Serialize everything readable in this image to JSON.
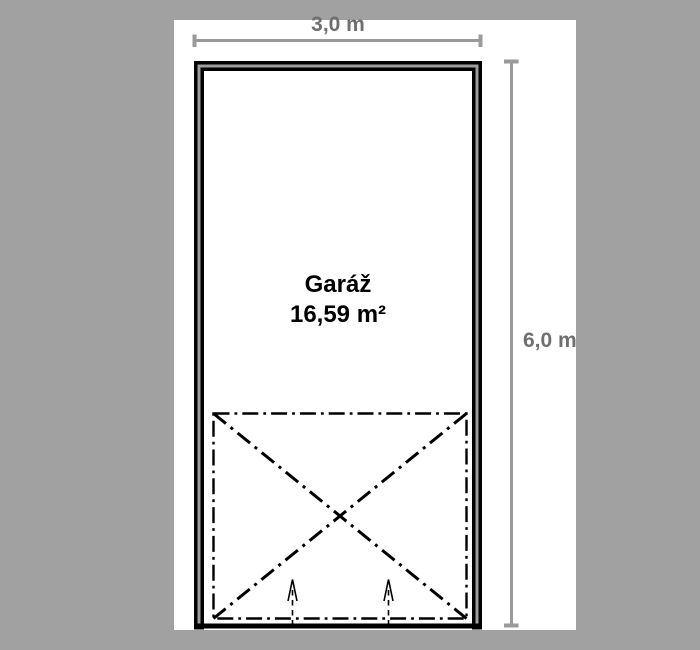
{
  "plan": {
    "room": {
      "name": "Garáž",
      "area": "16,59 m²"
    },
    "dimensions": {
      "width_label": "3,0 m",
      "height_label": "6,0 m"
    },
    "symbols": {
      "garage_door": "dash-dot rectangle with corner-to-corner X diagonals",
      "opening_direction": "two dashed arrows pointing up (inward) through the opening"
    }
  },
  "colors": {
    "background": "#a1a1a1",
    "paper": "#ffffff",
    "wall_line": "#000000",
    "wall_fill": "#9d9d9d",
    "dimension_line": "#9a9a9a",
    "dimension_text": "#6f6f6f",
    "room_text": "#000000"
  }
}
